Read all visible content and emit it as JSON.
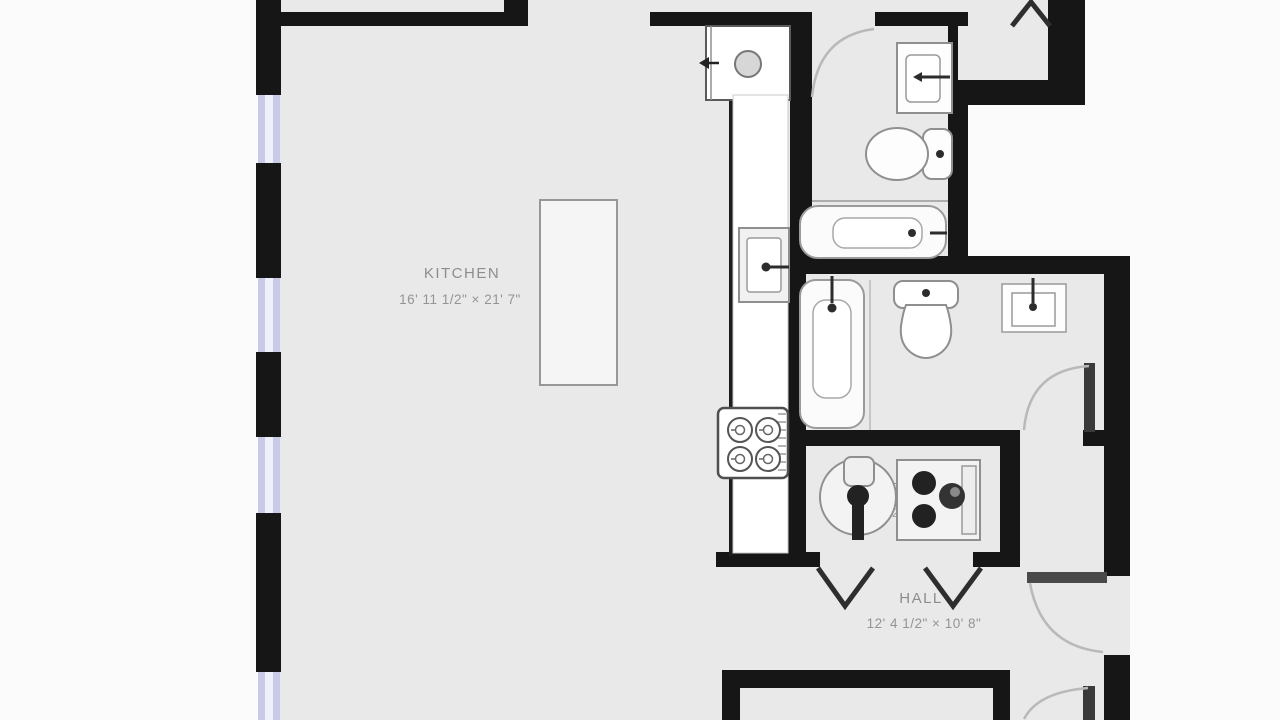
{
  "title": "Apartment floor plan",
  "colors": {
    "wall": "#161616",
    "floor": "#e9e9e9",
    "outside": "#fbfbfb",
    "window": "#c9c9e8",
    "window_core": "#eef0fa",
    "fixture_outline": "#8f8f8f",
    "fixture_fill": "#fafafa",
    "counter_fill": "#ffffff",
    "door_arc": "#b9b9b9",
    "door_leaf": "#3a3a3a",
    "label_text": "#8d8d8d"
  },
  "rooms": [
    {
      "name": "KITCHEN",
      "dimensions": "16' 11 1/2\" × 21' 7\""
    },
    {
      "name": "UTILITY",
      "dimensions": "7' 7 1/2\" × 7' 1/4\""
    },
    {
      "name": "HALL",
      "dimensions": "12' 4 1/2\" × 10' 8\""
    }
  ],
  "fixtures": [
    "refrigerator",
    "kitchen-counter",
    "kitchen-sink",
    "cooktop",
    "kitchen-island",
    "bathroom1-sink",
    "bathroom1-toilet",
    "bathroom1-bathtub",
    "bathroom2-bathtub",
    "bathroom2-toilet",
    "bathroom2-sink",
    "washer",
    "dryer"
  ],
  "doors": [
    "bathroom1-door",
    "closet-bifold-door",
    "bathroom2-door",
    "hall-bifold-door-left",
    "hall-bifold-door-right",
    "hall-right-door",
    "bottom-right-door"
  ],
  "windows": [
    "window-1",
    "window-2",
    "window-3",
    "window-4"
  ]
}
